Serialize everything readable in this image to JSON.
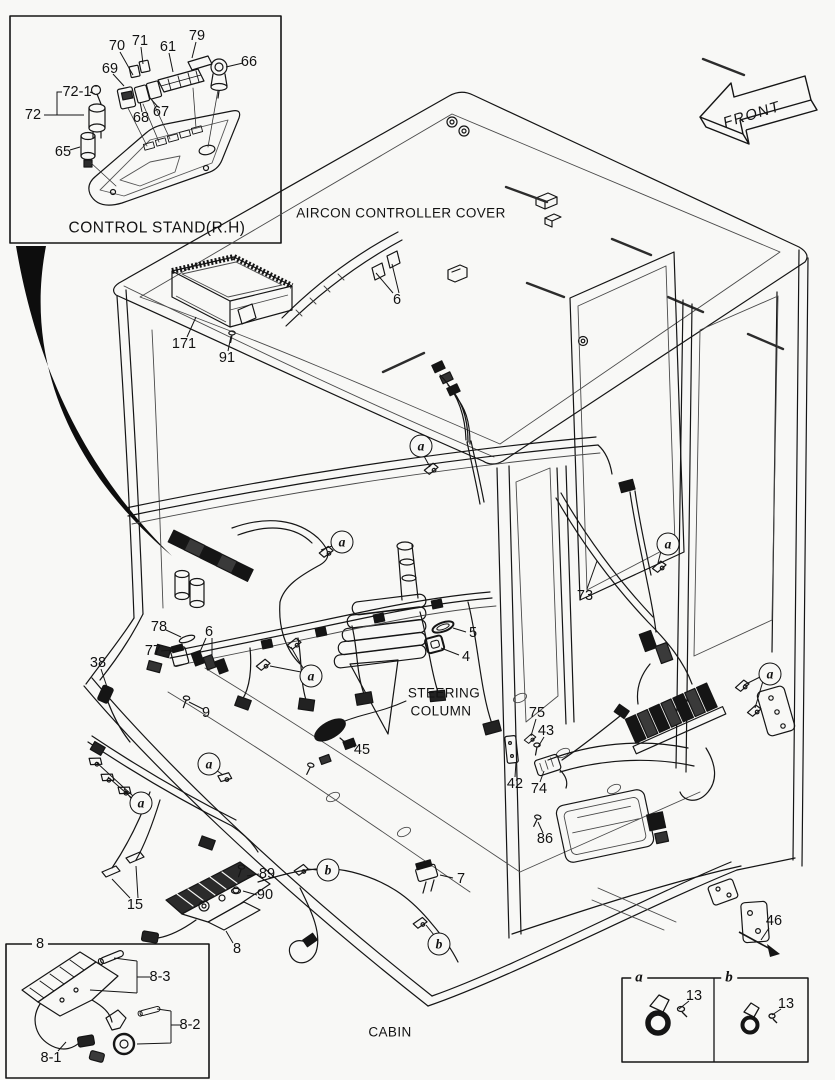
{
  "figure": {
    "front_label": "FRONT",
    "cabin_label": "CABIN",
    "aircon_label": "AIRCON CONTROLLER COVER",
    "steering_label_line1": "STEERING",
    "steering_label_line2": "COLUMN",
    "control_stand_title": "CONTROL STAND(R.H)",
    "ink_color": "#151515",
    "background_color": "#f8f8f6"
  },
  "legend": {
    "cell_a_label": "a",
    "cell_b_label": "b"
  },
  "callouts": [
    {
      "t": "70",
      "x": 117,
      "y": 46
    },
    {
      "t": "71",
      "x": 140,
      "y": 41
    },
    {
      "t": "61",
      "x": 168,
      "y": 47
    },
    {
      "t": "79",
      "x": 197,
      "y": 36
    },
    {
      "t": "66",
      "x": 249,
      "y": 62
    },
    {
      "t": "69",
      "x": 110,
      "y": 69
    },
    {
      "t": "72-1",
      "x": 77,
      "y": 92
    },
    {
      "t": "72",
      "x": 33,
      "y": 115
    },
    {
      "t": "68",
      "x": 141,
      "y": 118
    },
    {
      "t": "67",
      "x": 161,
      "y": 112
    },
    {
      "t": "65",
      "x": 63,
      "y": 152
    },
    {
      "t": "6",
      "x": 397,
      "y": 300
    },
    {
      "t": "171",
      "x": 184,
      "y": 344
    },
    {
      "t": "91",
      "x": 227,
      "y": 358
    },
    {
      "t": "73",
      "x": 585,
      "y": 596
    },
    {
      "t": "78",
      "x": 159,
      "y": 627
    },
    {
      "t": "6",
      "x": 209,
      "y": 632
    },
    {
      "t": "77",
      "x": 153,
      "y": 651
    },
    {
      "t": "38",
      "x": 98,
      "y": 663
    },
    {
      "t": "9",
      "x": 206,
      "y": 713
    },
    {
      "t": "5",
      "x": 473,
      "y": 633
    },
    {
      "t": "4",
      "x": 466,
      "y": 657
    },
    {
      "t": "45",
      "x": 362,
      "y": 750
    },
    {
      "t": "75",
      "x": 537,
      "y": 713
    },
    {
      "t": "43",
      "x": 546,
      "y": 731
    },
    {
      "t": "42",
      "x": 515,
      "y": 784
    },
    {
      "t": "74",
      "x": 539,
      "y": 789
    },
    {
      "t": "86",
      "x": 545,
      "y": 839
    },
    {
      "t": "15",
      "x": 135,
      "y": 905
    },
    {
      "t": "89",
      "x": 267,
      "y": 874
    },
    {
      "t": "90",
      "x": 265,
      "y": 895
    },
    {
      "t": "8",
      "x": 237,
      "y": 949
    },
    {
      "t": "7",
      "x": 461,
      "y": 879
    },
    {
      "t": "46",
      "x": 774,
      "y": 921
    },
    {
      "t": "8",
      "x": 40,
      "y": 944,
      "boxed": true
    },
    {
      "t": "8-3",
      "x": 160,
      "y": 977
    },
    {
      "t": "8-2",
      "x": 190,
      "y": 1025
    },
    {
      "t": "8-1",
      "x": 51,
      "y": 1058
    },
    {
      "t": "13",
      "x": 694,
      "y": 996
    },
    {
      "t": "13",
      "x": 786,
      "y": 1004
    }
  ],
  "markers": [
    {
      "l": "a",
      "x": 421,
      "y": 446
    },
    {
      "l": "a",
      "x": 342,
      "y": 542
    },
    {
      "l": "a",
      "x": 668,
      "y": 544
    },
    {
      "l": "a",
      "x": 311,
      "y": 676
    },
    {
      "l": "a",
      "x": 209,
      "y": 764
    },
    {
      "l": "a",
      "x": 141,
      "y": 803
    },
    {
      "l": "a",
      "x": 770,
      "y": 674
    },
    {
      "l": "b",
      "x": 328,
      "y": 870
    },
    {
      "l": "b",
      "x": 439,
      "y": 944
    }
  ]
}
